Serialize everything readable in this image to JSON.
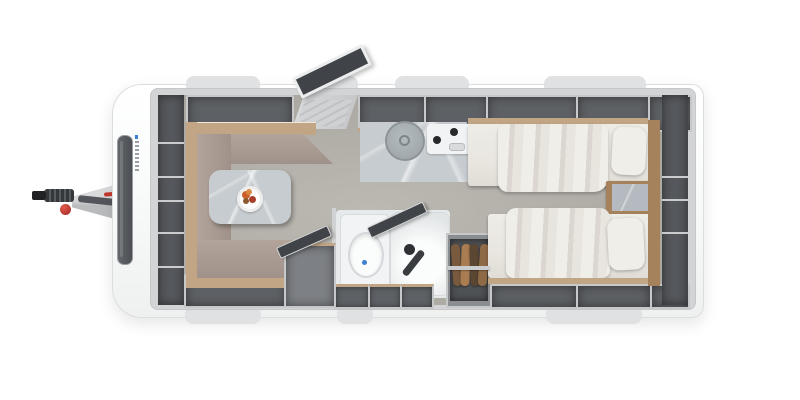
{
  "meta": {
    "view": "caravan-floorplan-top-view",
    "description": "Top-down 3D rendered floor plan of a single-axle travel trailer"
  },
  "colors": {
    "page_bg": "#ffffff",
    "body_shell": "#fafbfb",
    "body_edge": "#dcdddd",
    "wall_band": "#d3d4d6",
    "window_tab": "#e0e1e3",
    "floor_a": "#bcb8b2",
    "floor_b": "#aba7a1",
    "locker_face": "#c6c8ca",
    "locker_dark": "#5d6064",
    "storage_dark": "#55585c",
    "divider_light": "#c9cbcd",
    "wood": "#c2a584",
    "wood_dark": "#a5825c",
    "cushion_a": "#b2a49b",
    "cushion_b": "#a0928a",
    "marble": "#c7ccd0",
    "white_fixture": "#f1f3f4",
    "bath_floor": "#e7eaeb",
    "dark_panel": "#404347",
    "bed": "#e9e6e0",
    "bed_dark": "#dbd7d0",
    "pillow": "#f0eee9",
    "clothes_1": "#7a5a3e",
    "clothes_2": "#a97c52",
    "clothes_3": "#5b4632",
    "clothes_4": "#8f6a47",
    "red": "#c4392f",
    "hitch_a": "#d9dadc",
    "hitch_b": "#b9bbbd",
    "coupling": "#35383b",
    "window_glass_a": "#63676b",
    "window_glass_b": "#4b4f53",
    "sink_a": "#b4bcc0",
    "sink_b": "#99a1a5",
    "burner": "#26282a",
    "flush": "#3f7fd0",
    "rail": "#cbcdce",
    "fruit_a": "#c9602b",
    "fruit_b": "#a93f28",
    "fruit_c": "#d98a45",
    "fruit_d": "#8a5a2e"
  },
  "scene": {
    "zones": [
      {
        "id": "tow-hitch",
        "label": "Tow hitch and drawbar"
      },
      {
        "id": "front-storage",
        "label": "Front storage shelves"
      },
      {
        "id": "dinette",
        "label": "U-shaped dinette with pedestal table"
      },
      {
        "id": "entry-door",
        "label": "Entry door shown open"
      },
      {
        "id": "kitchen",
        "label": "Kitchen block with round sink and two-burner hob"
      },
      {
        "id": "bathroom",
        "label": "Bathroom with toilet and shower"
      },
      {
        "id": "wardrobe",
        "label": "Wardrobe with hanging clothes"
      },
      {
        "id": "bedroom",
        "label": "Twin single beds with bedside chest"
      },
      {
        "id": "rear-storage",
        "label": "Rear storage shelves"
      }
    ],
    "counts": {
      "beds": 2,
      "pillows": 2,
      "hob_burners": 2,
      "hanging_garments": 4,
      "top_wall_windows": 4,
      "bottom_wall_windows": 3
    }
  }
}
